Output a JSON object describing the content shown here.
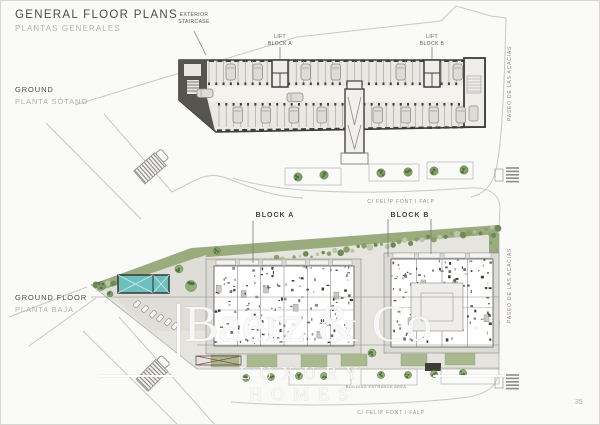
{
  "page": {
    "title": "GENERAL FLOOR PLANS",
    "subtitle": "PLANTAS GENERALES",
    "page_number": "35"
  },
  "upper_plan": {
    "name_en": "GROUND",
    "name_es": "PLANTA SÓTANO",
    "annotations": {
      "exterior_staircase": "EXTERIOR\nSTAIRCASE",
      "lift_block_a": "LIFT\nBLOCK A",
      "lift_block_b": "LIFT\nBLOCK B"
    },
    "streets": {
      "right": "PASEO DE LAS ACACIAS",
      "bottom": "C/ FELIP FONT I FALP"
    }
  },
  "lower_plan": {
    "name_en": "GROUND FLOOR",
    "name_es": "PLANTA BAJA",
    "annotations": {
      "block_a": "BLOCK A",
      "block_b": "BLOCK B",
      "building_entrance": "BUILDING ENTRANCE AREA"
    },
    "streets": {
      "right": "PASEO DE LAS ACACIAS",
      "bottom": "C/ FELIP FONT I FALP"
    }
  },
  "watermark": {
    "brand": "Baerz & Co",
    "tagline": "LUXURY HOMES"
  },
  "colors": {
    "pool": "#6cc0bd",
    "vegetation": "#9aab7e",
    "tree": "#7fa065",
    "building_fill": "#eae8e3",
    "wall_dark": "#3e3c39",
    "road_line": "#c9c7c3",
    "accent_text": "#4b4b4b",
    "muted_text": "#b5b2ac"
  }
}
